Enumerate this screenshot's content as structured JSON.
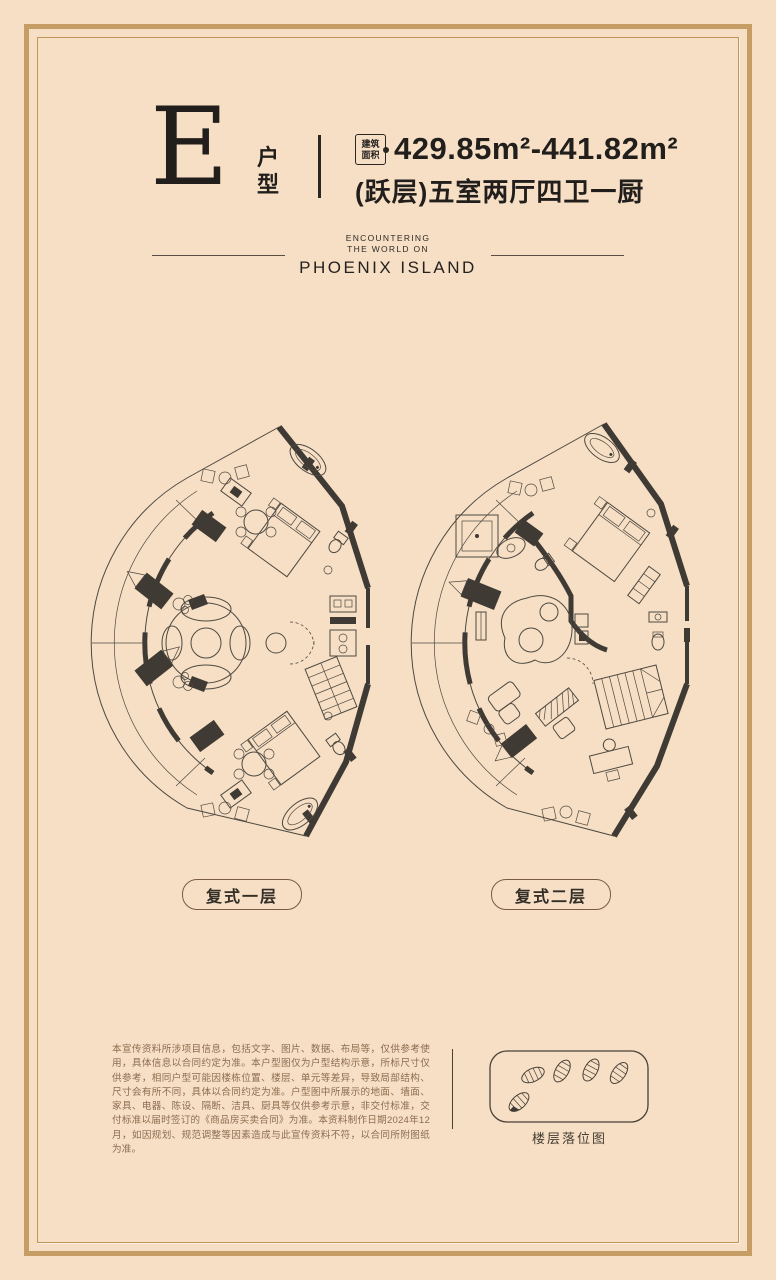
{
  "page": {
    "bg_color": "#f6dfc5",
    "frame_color": "#c59d65",
    "ink_color": "#24211e",
    "plan_line_color": "#4e4840",
    "muted_text_color": "#8d6d50"
  },
  "header": {
    "unit_letter": "E",
    "unit_label": [
      "户",
      "型"
    ],
    "area_badge": [
      "建筑",
      "面积"
    ],
    "area_range": "429.85m²-441.82m²",
    "layout_desc": "(跃层)五室两厅四卫一厨"
  },
  "brand": {
    "tagline_line1": "ENCOUNTERING",
    "tagline_line2": "THE WORLD ON",
    "name": "PHOENIX ISLAND"
  },
  "plans": [
    {
      "label": "复式一层"
    },
    {
      "label": "复式二层"
    }
  ],
  "footer": {
    "disclaimer": "本宣传资料所涉项目信息，包括文字、图片、数据、布局等，仅供参考使用，具体信息以合同约定为准。本户型图仅为户型结构示意，所标尺寸仅供参考，相同户型可能因楼栋位置、楼层、单元等差异，导致局部结构、尺寸会有所不同，具体以合同约定为准。户型图中所展示的地面、墙面、家具、电器、陈设、隔断、洁具、厨具等仅供参考示意，非交付标准，交付标准以届时签订的《商品房买卖合同》为准。本资料制作日期2024年12月，如因规划、规范调整等因素造成与此宣传资料不符，以合同所附图纸为准。",
    "diagram_caption": "楼层落位图"
  }
}
